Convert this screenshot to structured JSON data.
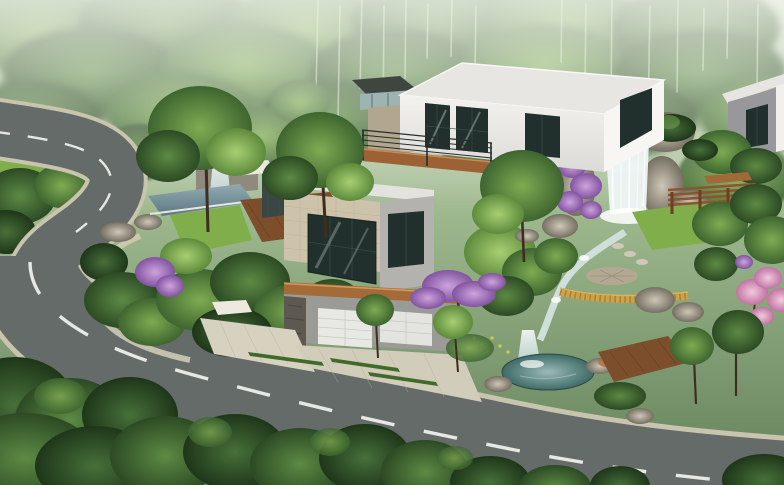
{
  "meta": {
    "title": "Aerial architectural rendering of a modern hillside villa",
    "view": "aerial three-quarter view",
    "contains_text": false
  },
  "palette": {
    "asphalt": "#646b69",
    "curb": "#c9c4ad",
    "lane_dash": "#e6e8e3",
    "forest_haze": "#d6e2cd",
    "lawn": "#7fae4b",
    "pool": "#6f8e96",
    "waterfall": "#eef6f6",
    "rock_light": "#b9b2a4",
    "wall_white": "#f1f0ec",
    "wall_sun": "#f7f6f3",
    "roof": "#e7e6e2",
    "wall_stone": "#cdc3aa",
    "wall_gray": "#b3b2ae",
    "glass": "#22302d",
    "wood_deck": "#7c4e2b",
    "wood_fascia": "#a46a38",
    "wood_balcony": "#9c6134",
    "garage_door": "#e8e8e4",
    "garage_wall": "#9a9a96",
    "stone_pillar": "#5d5950",
    "paving": "#d7d1c0",
    "grass_strip": "#3f6a2a",
    "blossom_purple": "#a878c2",
    "blossom_pink": "#dd9cc0",
    "fence_yellow": "#cda24a",
    "pergola_wood": "#8a5530",
    "stream": "#cfe0da",
    "plaza_stone": "#b3a892",
    "blue_ball": "#2f55cc",
    "neighbor_wall": "#98979c"
  },
  "scene": {
    "background": "misty green forest hillside with pale birch trunks",
    "road": "asphalt road curving from upper left around a planted island, then running along the bottom to the right, white dashed center line, light stone curbs",
    "main_villa": "two stacked flat-roofed cubes; white upper cube with dark framed glazing and wood balcony; lower cube with beige stone tile wall, corner glass, copper fascia, white garage doors, stone pillar and timber entry gate",
    "neighbor_villa": "partially visible flat-roofed white and gray building at upper right",
    "water_features": [
      "rock waterfall on the right",
      "stream with cascades",
      "teal garden pond lower right",
      "small lap pool with spout on left terrace"
    ],
    "garden": [
      "lawns",
      "bonsai style pines",
      "purple bougainvillea on rocks",
      "lilac blossom trees",
      "pink blossom trees at right edge",
      "timber pergola and bench",
      "yellow lattice fence",
      "round stone plaza",
      "timber boardwalk",
      "dense dark shrubs along the bottom edge"
    ]
  }
}
